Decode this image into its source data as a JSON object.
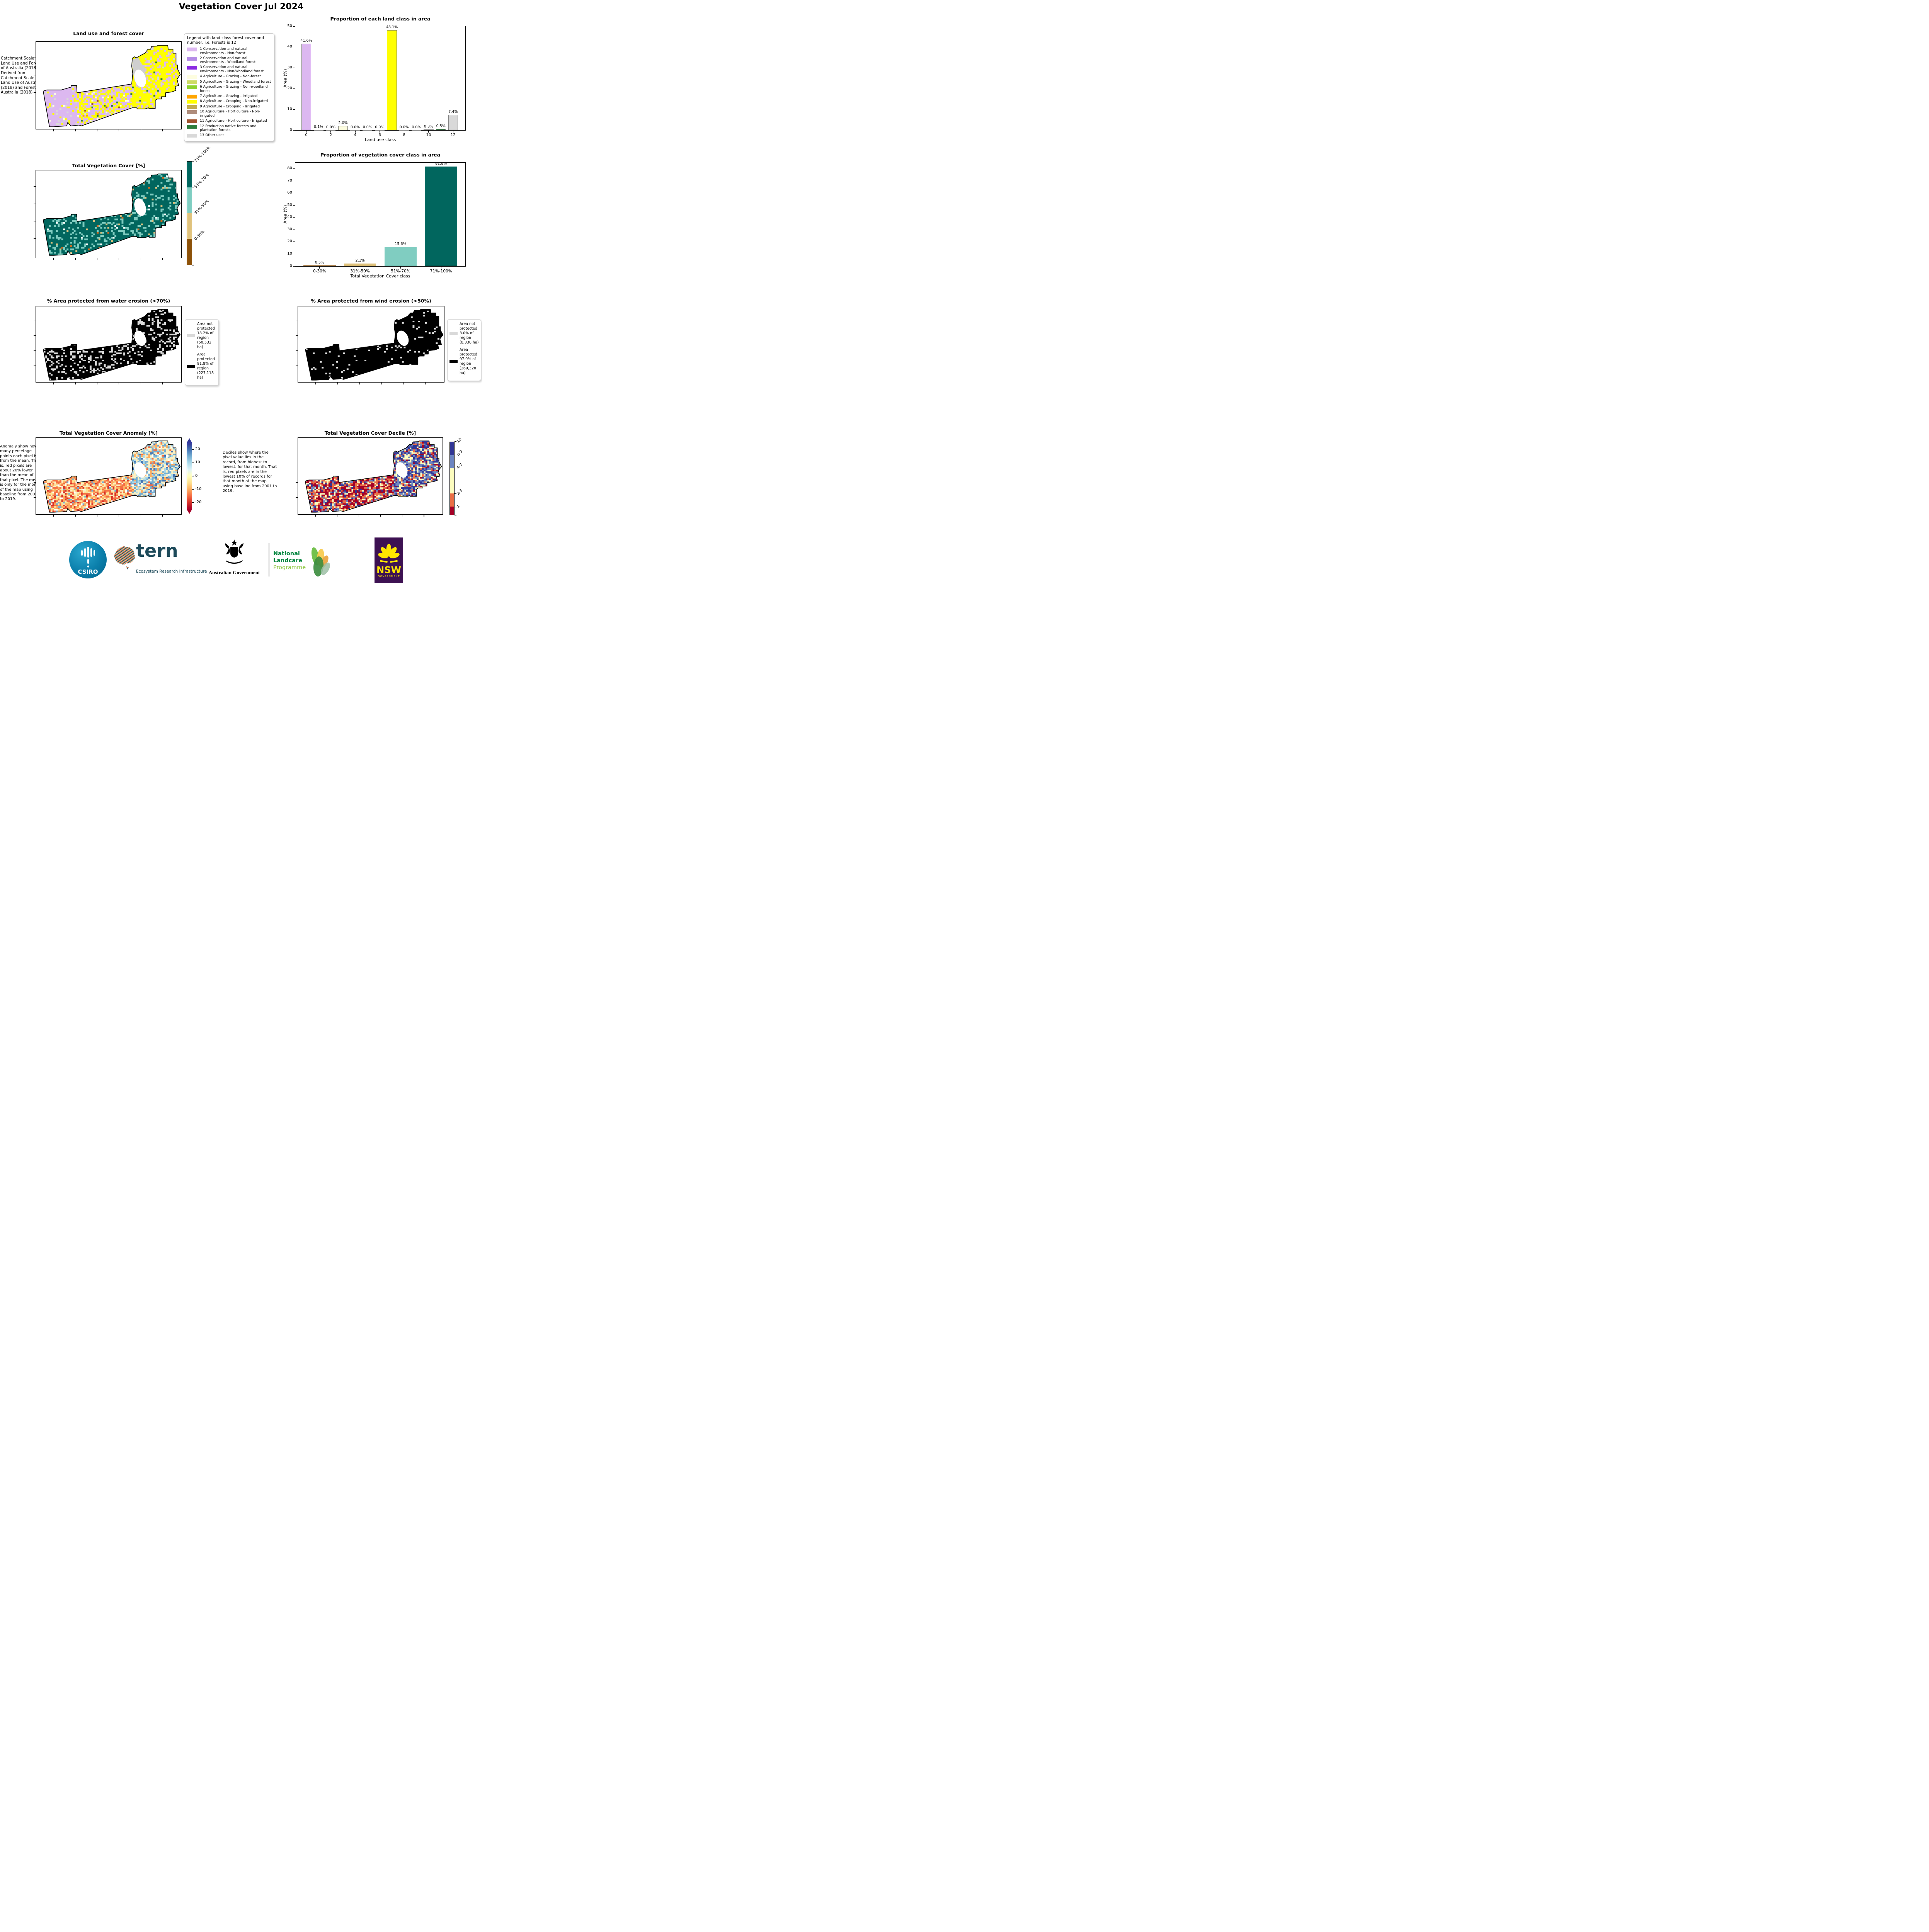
{
  "title": "Vegetation Cover Jul 2024",
  "chart_data": [
    {
      "type": "bar",
      "title": "Proportion of each land class in area",
      "xlabel": "Land use class",
      "ylabel": "Area (%)",
      "x": [
        0,
        1,
        2,
        3,
        4,
        5,
        6,
        7,
        8,
        9,
        10,
        11,
        12
      ],
      "values": [
        41.6,
        0.1,
        0.0,
        2.0,
        0.0,
        0.0,
        0.0,
        48.1,
        0.0,
        0.0,
        0.3,
        0.5,
        7.4
      ],
      "labels": [
        "41.6%",
        "0.1%",
        "0.0%",
        "2.0%",
        "0.0%",
        "0.0%",
        "0.0%",
        "48.1%",
        "0.0%",
        "0.0%",
        "0.3%",
        "0.5%",
        "7.4%"
      ],
      "bar_colors": [
        "#DCB8F0",
        "#B48CE6",
        "#8A2BE2",
        "#FDFDE0",
        "#CDDC64",
        "#8DD22E",
        "#FFA500",
        "#FFFF00",
        "#C2AC52",
        "#AF8D7C",
        "#A0522D",
        "#2E7D3C",
        "#D9D9D9"
      ],
      "edge_color": "#7f7f7f",
      "xticks": [
        0,
        2,
        4,
        6,
        8,
        10,
        12
      ],
      "yticks": [
        0,
        10,
        20,
        30,
        40,
        50
      ],
      "ylim": [
        0,
        50
      ],
      "xlim": [
        -0.9,
        13.0
      ],
      "grid": false,
      "legend_position": "none"
    },
    {
      "type": "bar",
      "title": "Proportion of vegetation cover class in area",
      "xlabel": "Total Vegetation Cover class",
      "ylabel": "Area (%)",
      "categories": [
        "0-30%",
        "31%-50%",
        "51%-70%",
        "71%-100%"
      ],
      "values": [
        0.5,
        2.1,
        15.6,
        81.8
      ],
      "labels": [
        "0.5%",
        "2.1%",
        "15.6%",
        "81.8%"
      ],
      "bar_colors": [
        "#8C5109",
        "#DFC27D",
        "#80CDC1",
        "#01665E"
      ],
      "edge_color": "none",
      "yticks": [
        0,
        10,
        20,
        30,
        40,
        50,
        60,
        70,
        80
      ],
      "ylim": [
        0,
        85
      ],
      "xlim": [
        -0.6,
        3.6
      ],
      "grid": false,
      "legend_position": "none"
    }
  ],
  "maps": {
    "landuse": {
      "title": "Land use and forest cover",
      "side_note": " Catchment Scale Land Use and Forests of Australia (2018) Derived from Catchment Scale Land Use of Australia (2018) and Forests of Australia (2018)",
      "legend_title": "Legend with land class forest cover and number, i.e. Forests is 12",
      "legend_items": [
        {
          "label": "1 Conservation and natural environments - Non-forest",
          "color": "#DCB8F0"
        },
        {
          "label": "2 Conservation and natural environments - Woodland forest",
          "color": "#B48CE6"
        },
        {
          "label": "3 Conservation and natural environments - Non-Woodland forest",
          "color": "#8A2BE2"
        },
        {
          "label": "4 Agriculture - Grazing - Non-forest",
          "color": "#FDFDE0"
        },
        {
          "label": "5 Agriculture - Grazing - Woodland forest",
          "color": "#CDDC64"
        },
        {
          "label": "6 Agriculture - Grazing - Non-woodland forest",
          "color": "#8DD22E"
        },
        {
          "label": "7 Agriculture - Grazing - Irrigated",
          "color": "#FFA500"
        },
        {
          "label": "8 Agriculture - Cropping - Non-irrigated",
          "color": "#FFFF00"
        },
        {
          "label": "9 Agriculture - Cropping - Irrigated",
          "color": "#C2AC52"
        },
        {
          "label": "10 Agriculture - Horticulture - Non-irrigated",
          "color": "#AF8D7C"
        },
        {
          "label": "11 Agriculture - Horticulture - Irrigated",
          "color": "#A0522D"
        },
        {
          "label": "12 Production native forests and plantation forests",
          "color": "#2E7D3C"
        },
        {
          "label": "13 Other uses",
          "color": "#D9D9D9"
        }
      ],
      "base": "#DCB8F0",
      "lobe_fill": "#FFFF00",
      "lake": true,
      "gray_patch": "#CFCFCF",
      "seed": 11,
      "noise": [
        {
          "x0": 0,
          "x1": 28,
          "colors": [
            [
              "#FFFF00",
              0.05
            ],
            [
              "#D9D9D9",
              0.05
            ],
            [
              "#FDFDE0",
              0.012
            ]
          ]
        },
        {
          "x0": 28,
          "x1": 66,
          "colors": [
            [
              "#FFFF00",
              0.42
            ],
            [
              "#D9D9D9",
              0.05
            ],
            [
              "#FDFDE0",
              0.035
            ],
            [
              "#2E7D3C",
              0.014
            ],
            [
              "#A0522D",
              0.007
            ],
            [
              "#FFA500",
              0.005
            ]
          ]
        },
        {
          "x0": 66,
          "x1": 100,
          "colors": [
            [
              "#DCB8F0",
              0.15
            ],
            [
              "#D9D9D9",
              0.04
            ],
            [
              "#2E7D3C",
              0.012
            ]
          ]
        }
      ]
    },
    "vegcover": {
      "title": "Total Vegetation Cover [%]",
      "base": "#01665E",
      "lake": true,
      "seed": 7,
      "noise": [
        {
          "x0": 0,
          "x1": 100,
          "colors": [
            [
              "#80CDC1",
              0.17
            ],
            [
              "#DFC27D",
              0.015
            ],
            [
              "#D2691E",
              0.007
            ],
            [
              "#FFFFFF",
              0.012
            ]
          ]
        }
      ],
      "colorbar": {
        "labels": [
          "71%-100%",
          "51%-70%",
          "31%-50%",
          "0-30%"
        ],
        "colors": [
          "#01665E",
          "#80CDC1",
          "#DFC27D",
          "#8C5109"
        ],
        "heights": [
          25,
          25,
          25,
          25
        ]
      }
    },
    "water": {
      "title": "% Area protected from water erosion (>70%)",
      "base": "#000000",
      "lake": true,
      "seed": 3,
      "noise": [
        {
          "x0": 0,
          "x1": 100,
          "colors": [
            [
              "#DCDCDC",
              0.21
            ]
          ]
        }
      ],
      "legend_items": [
        {
          "label": "Area not protected 18.2% of region (50,532 ha)",
          "color": "#D9D9D9"
        },
        {
          "label": "Area protected 81.8% of region (227,118 ha)",
          "color": "#000000"
        }
      ]
    },
    "wind": {
      "title": "% Area protected from wind erosion (>50%)",
      "base": "#000000",
      "lake": true,
      "seed": 5,
      "noise": [
        {
          "x0": 0,
          "x1": 100,
          "colors": [
            [
              "#DCDCDC",
              0.045
            ]
          ]
        }
      ],
      "legend_items": [
        {
          "label": "Area not protected 3.0% of region (8,330 ha)",
          "color": "#D9D9D9"
        },
        {
          "label": "Area protected 97.0% of region (269,320 ha)",
          "color": "#000000"
        }
      ]
    },
    "anomaly": {
      "title": "Total Vegetation Cover Anomaly [%]",
      "note": "Anomaly show how many percetage points each pixel is from the mean. That is, red pixels are about 20% lower than the mean of that pixel. The mean is only for the month of the map using baseline from 2001 to 2019.",
      "base": "#FBF0C2",
      "lake": true,
      "seed": 9,
      "noise": [
        {
          "x0": 0,
          "x1": 66,
          "colors": [
            [
              "#D73027",
              0.11
            ],
            [
              "#F46D43",
              0.22
            ],
            [
              "#FDAE61",
              0.22
            ],
            [
              "#FEE090",
              0.14
            ],
            [
              "#74ADD1",
              0.05
            ],
            [
              "#FFFFFF",
              0.05
            ]
          ]
        },
        {
          "x0": 66,
          "x1": 100,
          "colors": [
            [
              "#74ADD1",
              0.2
            ],
            [
              "#ABD9E9",
              0.16
            ],
            [
              "#4575B4",
              0.08
            ],
            [
              "#FDAE61",
              0.1
            ],
            [
              "#F46D43",
              0.05
            ],
            [
              "#FFFFFF",
              0.06
            ]
          ]
        }
      ],
      "colorbar": {
        "ticks": [
          "20",
          "10",
          "0",
          "-10",
          "-20"
        ],
        "gradient": [
          "#A50026",
          "#D73027",
          "#F46D43",
          "#FDAE61",
          "#FEE090",
          "#FFFFBF",
          "#E0F3F8",
          "#ABD9E9",
          "#74ADD1",
          "#4575B4",
          "#313695"
        ]
      }
    },
    "decile": {
      "title": "Total Vegetation Cover Decile [%]",
      "note": "Deciles show where the pixel value lies in the record, from highest to lowest, for that month. That is, red pixels are in the lowest 10% of records for that month of the map using baseline from 2001 to 2019.",
      "base": "#FDFDBF",
      "lake": true,
      "seed": 13,
      "noise": [
        {
          "x0": 0,
          "x1": 66,
          "colors": [
            [
              "#A50026",
              0.33
            ],
            [
              "#EA6E45",
              0.25
            ],
            [
              "#313695",
              0.1
            ],
            [
              "#6C85C2",
              0.09
            ]
          ]
        },
        {
          "x0": 66,
          "x1": 100,
          "colors": [
            [
              "#313695",
              0.3
            ],
            [
              "#6C85C2",
              0.26
            ],
            [
              "#EA6E45",
              0.12
            ],
            [
              "#A50026",
              0.08
            ]
          ]
        }
      ],
      "colorbar": {
        "labels": [
          "10",
          "8-9",
          "4-7",
          "2-3",
          "1"
        ],
        "colors": [
          "#313695",
          "#6C85C2",
          "#FDFDBF",
          "#EA6E45",
          "#A50026"
        ],
        "heights": [
          18,
          18,
          35,
          18,
          11
        ]
      }
    }
  },
  "footer": {
    "csiro": "CSIRO",
    "tern": "tern",
    "tern_tagline": "Ecosystem Research Infrastructure",
    "aus_gov": "Australian Government",
    "nlp_lines": [
      "National",
      "Landcare",
      "Programme"
    ],
    "nsw": "NSW",
    "nsw_sub": "GOVERNMENT",
    "colors": {
      "csiro_teal": "#0B7FAB",
      "tern_teal": "#1D4A5A",
      "nlp_green": "#00843D",
      "nlp_light_green": "#8CC63E",
      "nsw_purple": "#3D1152",
      "waratah_yellow": "#FFE600"
    }
  }
}
